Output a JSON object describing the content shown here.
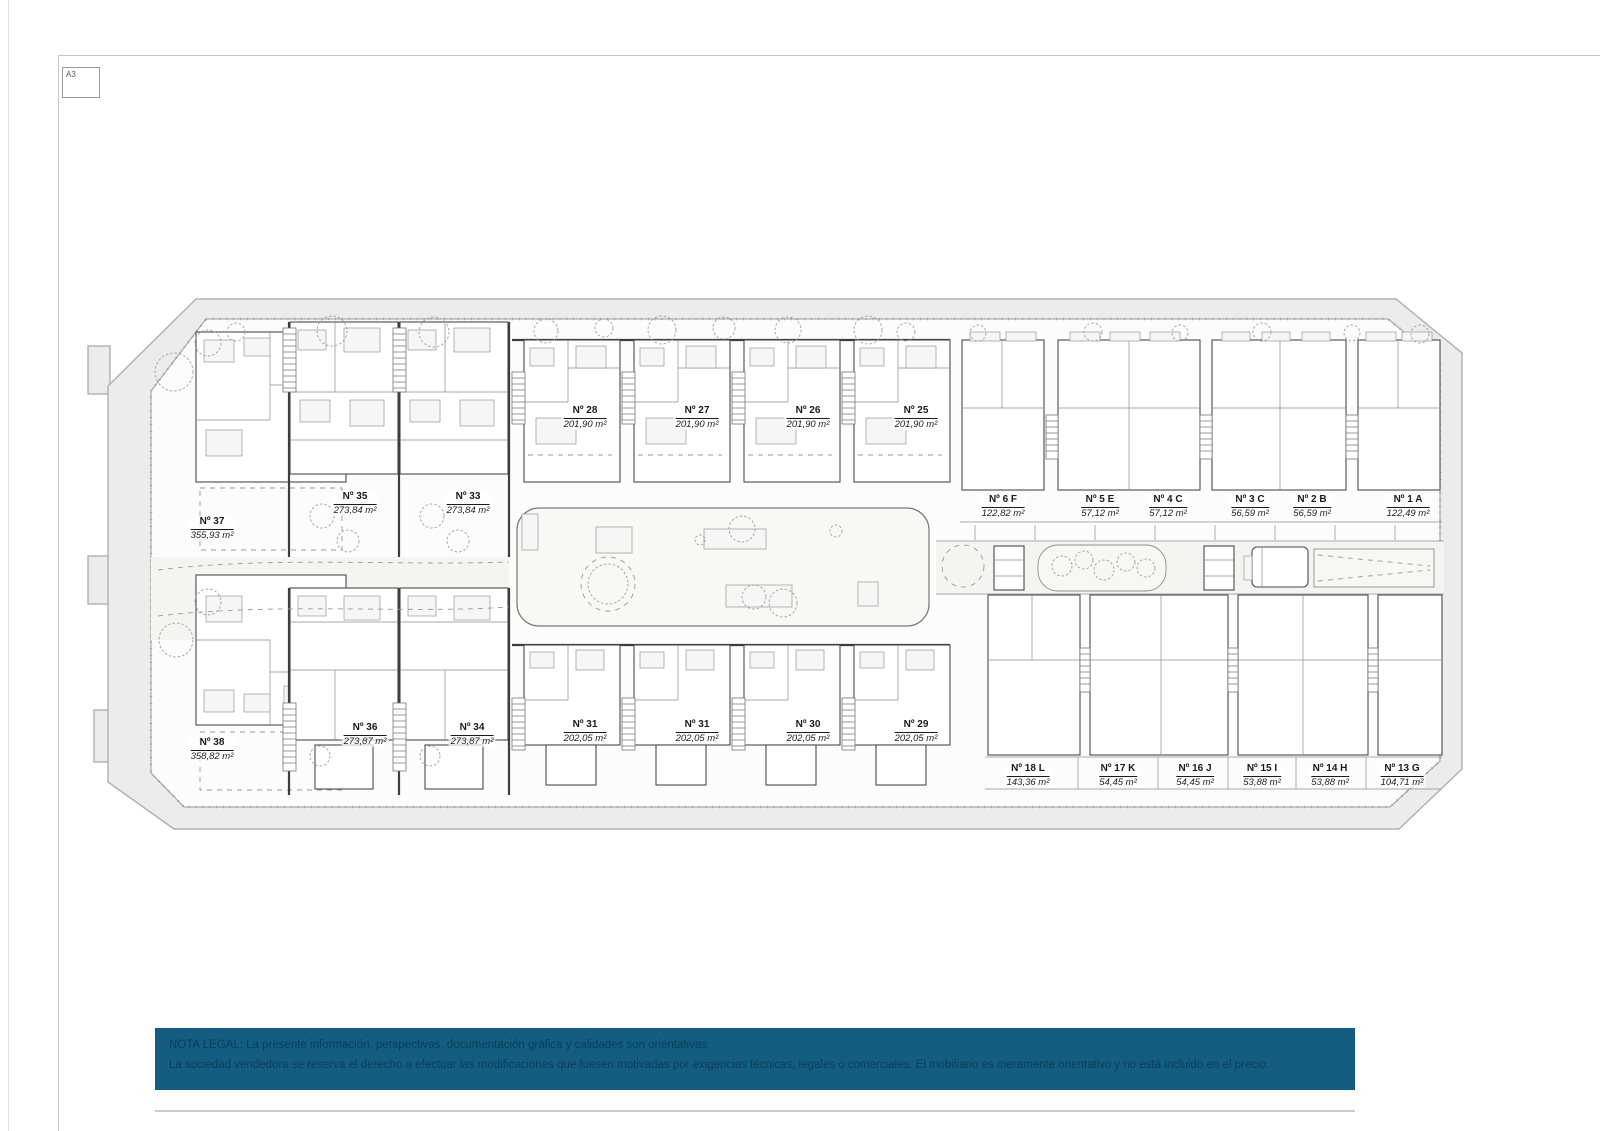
{
  "page": {
    "sheet_label": "A3"
  },
  "colors": {
    "banner_bg": "#135E80",
    "banner_text": "#0C3B58",
    "site_band_fill": "#ECECEA",
    "plan_line": "#4A4A4A"
  },
  "plan": {
    "units": [
      {
        "name": "Nº 37",
        "area": "355,93 m²"
      },
      {
        "name": "Nº 35",
        "area": "273,84 m²"
      },
      {
        "name": "Nº 33",
        "area": "273,84 m²"
      },
      {
        "name": "Nº 28",
        "area": "201,90 m²"
      },
      {
        "name": "Nº 27",
        "area": "201,90 m²"
      },
      {
        "name": "Nº 26",
        "area": "201,90 m²"
      },
      {
        "name": "Nº 25",
        "area": "201,90 m²"
      },
      {
        "name": "Nº 6 F",
        "area": "122,82 m²"
      },
      {
        "name": "Nº 5 E",
        "area": "57,12 m²"
      },
      {
        "name": "Nº 4 C",
        "area": "57,12 m²"
      },
      {
        "name": "Nº 3 C",
        "area": "56,59 m²"
      },
      {
        "name": "Nº 2 B",
        "area": "56,59 m²"
      },
      {
        "name": "Nº 1 A",
        "area": "122,49 m²"
      },
      {
        "name": "Nº 38",
        "area": "358,82 m²"
      },
      {
        "name": "Nº 36",
        "area": "273,87 m²"
      },
      {
        "name": "Nº 34",
        "area": "273,87 m²"
      },
      {
        "name": "Nº 31",
        "area": "202,05 m²"
      },
      {
        "name": "Nº 31",
        "area": "202,05 m²"
      },
      {
        "name": "Nº 30",
        "area": "202,05 m²"
      },
      {
        "name": "Nº 29",
        "area": "202,05 m²"
      },
      {
        "name": "Nº 18 L",
        "area": "143,36 m²"
      },
      {
        "name": "Nº 17 K",
        "area": "54,45 m²"
      },
      {
        "name": "Nº 16 J",
        "area": "54,45 m²"
      },
      {
        "name": "Nº 15 I",
        "area": "53,88 m²"
      },
      {
        "name": "Nº 14 H",
        "area": "53,88 m²"
      },
      {
        "name": "Nº 13 G",
        "area": "104,71 m²"
      }
    ]
  },
  "legal": {
    "line1": "NOTA LEGAL: La presente información, perspectivas, documentación gráfica y calidades son orientativas.",
    "line2": "La sociedad vendedora se reserva el derecho a efectuar las modificaciones que fuesen motivadas por exigencias técnicas, legales o comerciales. El mobiliario es meramente orientativo y no está incluido en el precio."
  }
}
